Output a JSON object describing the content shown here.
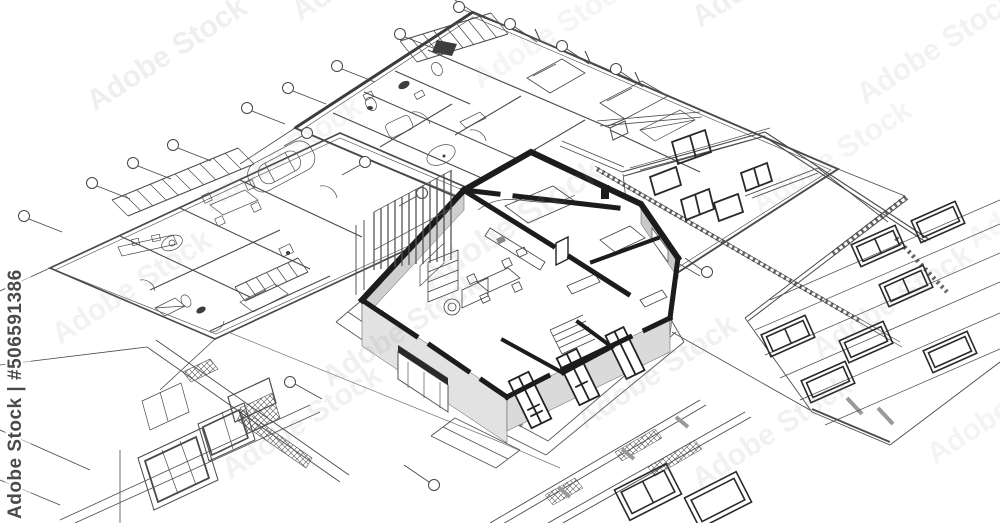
{
  "watermarks": {
    "tile_text": "Adobe Stock",
    "side_text": "Adobe Stock | #506591386"
  },
  "palette": {
    "background": "#ffffff",
    "thin_line": "#4a4a4a",
    "medium_line": "#555555",
    "bold_wall": "#1c1c1c",
    "wall_face_light": "#e2e2e2",
    "wall_face_mid": "#d4d4d4",
    "wall_face_dark": "#c9c9c9",
    "watermark_gray": "#8a8a85"
  },
  "scene": {
    "description": "3D cutaway model of a house standing on a collage of architectural blueprints: floor plans with furniture and a car, a gable house elevation, a window facade elevation, window detail drawings, hatched wall bands and grid callout bubbles",
    "elements": [
      "house-3d-model",
      "floor-plan-upper",
      "floor-plan-left",
      "gable-elevation",
      "facade-elevation",
      "window-detail-drawings",
      "site-bands",
      "callout-bubbles",
      "pergola-slats",
      "terrace-steps",
      "car-outline"
    ]
  }
}
